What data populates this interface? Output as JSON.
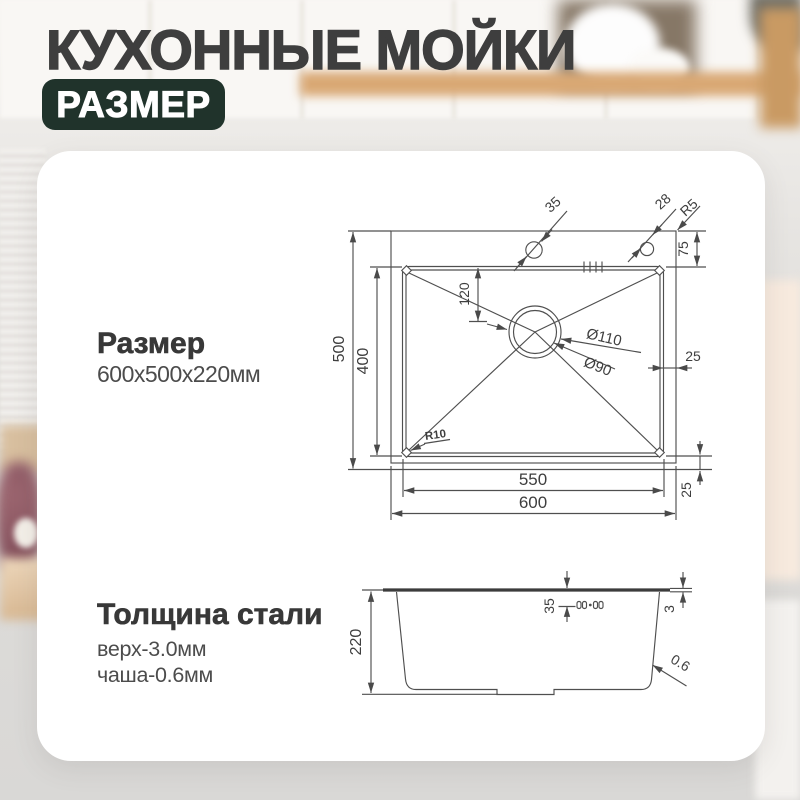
{
  "header": {
    "title": "КУХОННЫЕ МОЙКИ",
    "badge": "РАЗМЕР"
  },
  "size_section": {
    "heading": "Размер",
    "value": "600x500x220мм"
  },
  "thickness_section": {
    "heading": "Толщина стали",
    "line1": "верх-3.0мм",
    "line2": "чаша-0.6мм"
  },
  "top_view": {
    "hole1_diameter": "35",
    "hole2_diameter": "28",
    "deck_corner_radius": "R5",
    "deck_top_depth": "75",
    "drain_offset_from_top": "120",
    "drain_outer_diameter": "Ø110",
    "drain_inner_diameter": "Ø90",
    "deck_right_width": "25",
    "outer_depth": "500",
    "bowl_depth": "400",
    "bowl_corner_radius": "R10",
    "bowl_width": "550",
    "outer_width": "600",
    "deck_bottom_width": "25"
  },
  "side_view": {
    "height": "220",
    "rim_inset": "35",
    "top_thickness": "3",
    "wall_thickness": "0.6"
  },
  "colors": {
    "badge_bg": "#20332b",
    "title_text": "#3e3e3e",
    "card_bg": "#ffffff",
    "drawing_line": "#4f4f4f"
  }
}
